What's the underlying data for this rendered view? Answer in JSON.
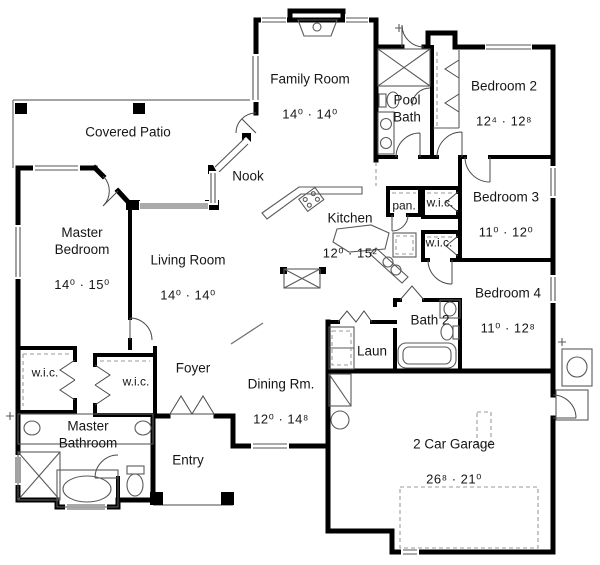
{
  "plan_title": "House Floor Plan",
  "colors": {
    "wall": "#000000",
    "thin_line": "#6e6e6e",
    "dashed_line": "#9a9a9a",
    "background": "#ffffff",
    "text": "#161616"
  },
  "rooms": {
    "family_room": {
      "name": "Family Room",
      "dims": "14⁰ · 14⁰"
    },
    "pool_bath": {
      "name": "Pool\nBath"
    },
    "bedroom2": {
      "name": "Bedroom 2",
      "dims": "12⁴ · 12⁸"
    },
    "covered_patio": {
      "name": "Covered Patio"
    },
    "nook": {
      "name": "Nook"
    },
    "pantry": {
      "name": "pan."
    },
    "wic_bedroom3": {
      "name": "w.i.c."
    },
    "kitchen": {
      "name": "Kitchen",
      "dims": "12⁰ · 15²"
    },
    "wic_bedroom4": {
      "name": "w.i.c."
    },
    "bedroom3": {
      "name": "Bedroom 3",
      "dims": "11⁰ · 12⁰"
    },
    "master_bedroom": {
      "name": "Master\nBedroom",
      "dims": "14⁰ · 15⁰"
    },
    "living_room": {
      "name": "Living Room",
      "dims": "14⁰ · 14⁰"
    },
    "bedroom4": {
      "name": "Bedroom 4",
      "dims": "11⁰ · 12⁸"
    },
    "bath2": {
      "name": "Bath 2"
    },
    "laundry": {
      "name": "Laun"
    },
    "wic_master_1": {
      "name": "w.i.c."
    },
    "wic_master_2": {
      "name": "w.i.c."
    },
    "foyer": {
      "name": "Foyer"
    },
    "dining_room": {
      "name": "Dining Rm.",
      "dims": "12⁰ · 14⁸"
    },
    "master_bathroom": {
      "name": "Master\nBathroom"
    },
    "entry": {
      "name": "Entry"
    },
    "garage": {
      "name": "2 Car Garage",
      "dims": "26⁸ · 21⁰"
    }
  }
}
